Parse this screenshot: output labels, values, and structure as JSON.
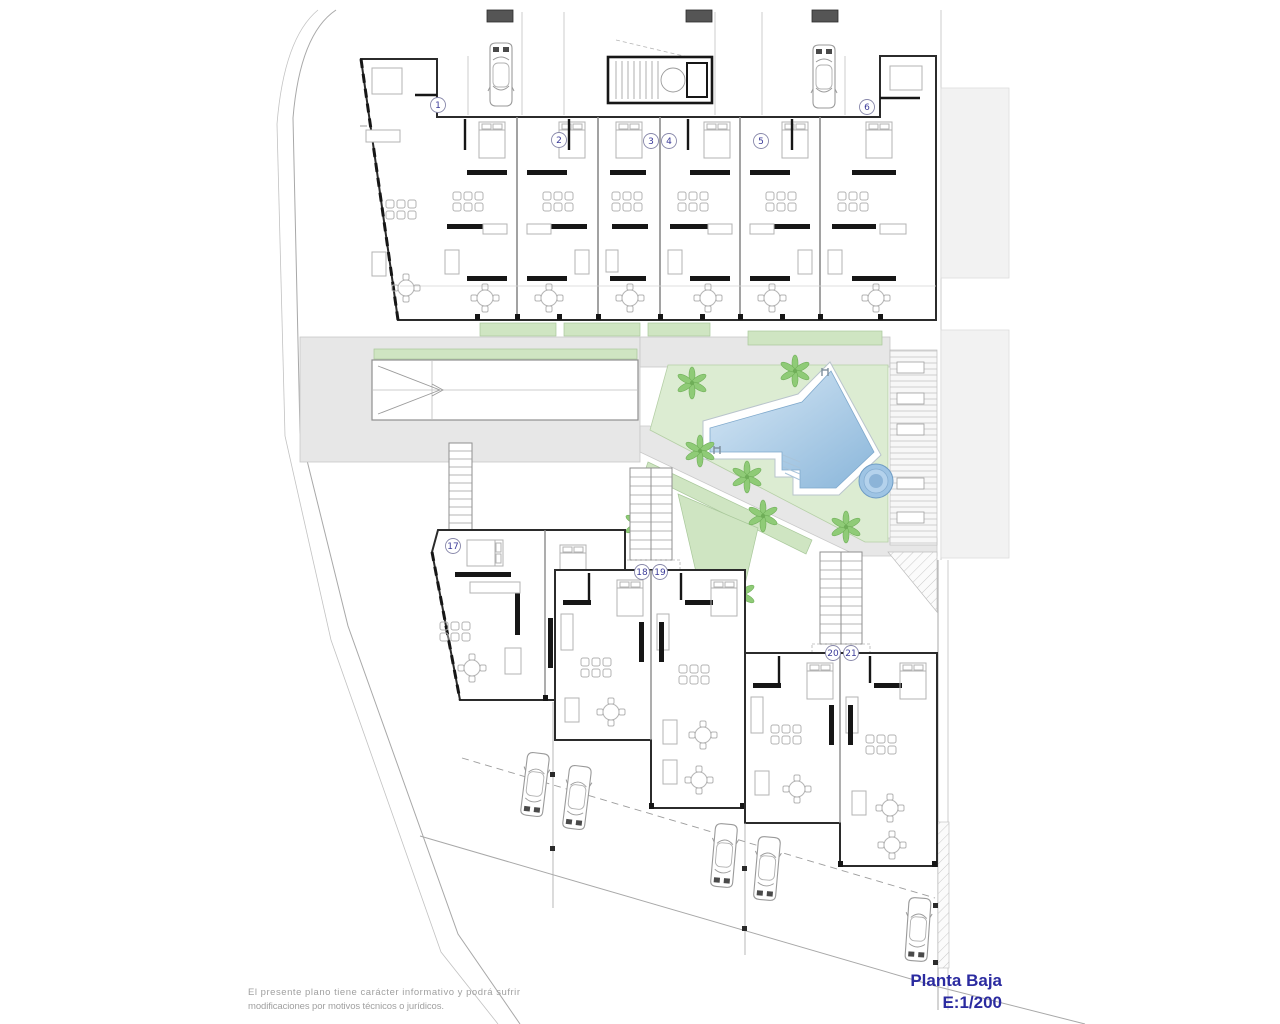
{
  "meta": {
    "drawing_type": "architectural-floor-plan",
    "floor": "Planta Baja",
    "scale": "E:1/200"
  },
  "title": {
    "line1": "Planta Baja",
    "line2": "E:1/200",
    "color": "#2b2ba0"
  },
  "disclaimer": {
    "line1": "El presente plano tiene carácter informativo y podrá sufrir",
    "line2": "modificaciones por motivos técnicos o jurídicos."
  },
  "units": {
    "top": [
      {
        "n": "1",
        "x": 438,
        "y": 105
      },
      {
        "n": "2",
        "x": 559,
        "y": 140
      },
      {
        "n": "3",
        "x": 651,
        "y": 141
      },
      {
        "n": "4",
        "x": 669,
        "y": 141
      },
      {
        "n": "5",
        "x": 761,
        "y": 141
      },
      {
        "n": "6",
        "x": 867,
        "y": 107
      }
    ],
    "bottom": [
      {
        "n": "17",
        "x": 453,
        "y": 546
      },
      {
        "n": "18",
        "x": 642,
        "y": 572
      },
      {
        "n": "19",
        "x": 660,
        "y": 572
      },
      {
        "n": "20",
        "x": 833,
        "y": 653
      },
      {
        "n": "21",
        "x": 851,
        "y": 653
      }
    ]
  },
  "features": {
    "pool": "swimming-pool",
    "jacuzzi": "round-jacuzzi",
    "lawn": "garden-lawn",
    "deck": "sun-deck-with-loungers",
    "ramp": "garage-ramp",
    "stairs": "staircases",
    "cars": "parked-cars",
    "palms": "palm-trees"
  },
  "colors": {
    "pool_light": "#d9e9f6",
    "pool_dark": "#8ab6da",
    "jacuzzi": "#9ec4e4",
    "lawn": "#dcecd2",
    "green_strip": "#cfe5c2",
    "palm": "#8fcb77",
    "path_gray": "#e7e7e7",
    "wall": "#2b2b2b",
    "title_blue": "#2b2ba0",
    "disclaimer_gray": "#a0a0a0",
    "badge_blue": "#3a3a99"
  }
}
